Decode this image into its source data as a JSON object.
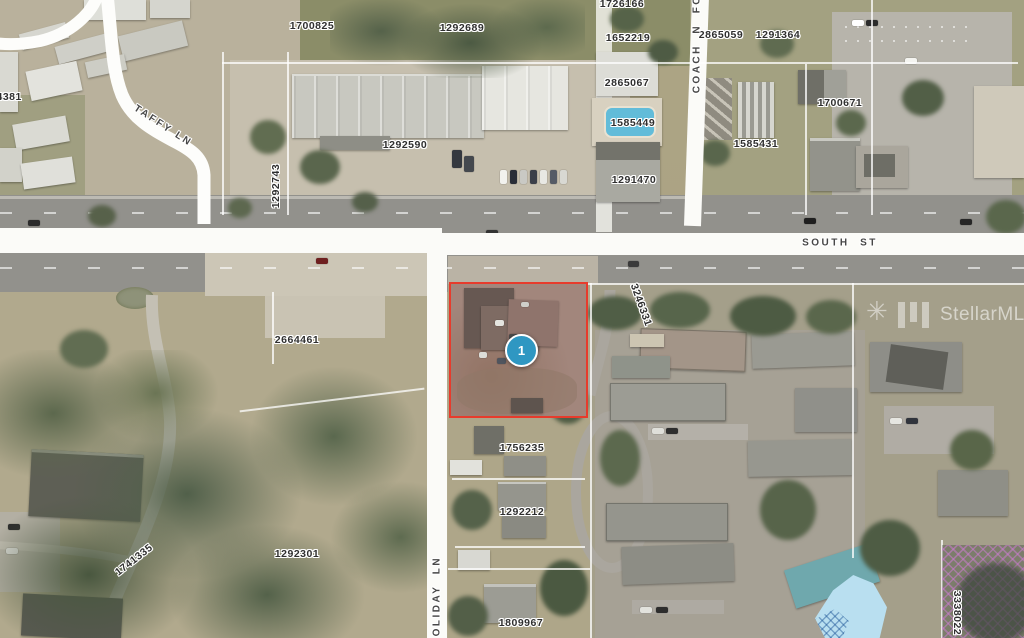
{
  "map": {
    "street_labels": [
      {
        "text": "TAFFY LN",
        "x": 163,
        "y": 126,
        "rot": 33
      },
      {
        "text": "SOUTH  ST",
        "x": 840,
        "y": 243,
        "rot": 0
      },
      {
        "text": "COACH  N  FOU",
        "x": 697,
        "y": 39,
        "rot": -90
      },
      {
        "text": "HOLIDAY  LN",
        "x": 437,
        "y": 601,
        "rot": -90
      }
    ],
    "parcel_labels": [
      {
        "text": "1700825",
        "x": 312,
        "y": 26,
        "rot": 0
      },
      {
        "text": "1292689",
        "x": 462,
        "y": 28,
        "rot": 0
      },
      {
        "text": "1726166",
        "x": 622,
        "y": 4,
        "rot": 0
      },
      {
        "text": "1652219",
        "x": 628,
        "y": 38,
        "rot": 0
      },
      {
        "text": "2865059",
        "x": 721,
        "y": 35,
        "rot": 0
      },
      {
        "text": "1291364",
        "x": 778,
        "y": 35,
        "rot": 0
      },
      {
        "text": "2865067",
        "x": 627,
        "y": 83,
        "rot": 0
      },
      {
        "text": "1585449",
        "x": 633,
        "y": 123,
        "rot": 0
      },
      {
        "text": "1700671",
        "x": 840,
        "y": 103,
        "rot": 0
      },
      {
        "text": "1585431",
        "x": 756,
        "y": 144,
        "rot": 0
      },
      {
        "text": "1292590",
        "x": 405,
        "y": 145,
        "rot": 0
      },
      {
        "text": "1291470",
        "x": 634,
        "y": 180,
        "rot": 0
      },
      {
        "text": "74381",
        "x": 6,
        "y": 97,
        "rot": 0
      },
      {
        "text": "1292743",
        "x": 276,
        "y": 186,
        "rot": -90
      },
      {
        "text": "3246331",
        "x": 641,
        "y": 305,
        "rot": 70
      },
      {
        "text": "2664461",
        "x": 297,
        "y": 340,
        "rot": 0
      },
      {
        "text": "1756235",
        "x": 522,
        "y": 448,
        "rot": 0
      },
      {
        "text": "1292212",
        "x": 522,
        "y": 512,
        "rot": 0
      },
      {
        "text": "1292301",
        "x": 297,
        "y": 554,
        "rot": 0
      },
      {
        "text": "1741335",
        "x": 134,
        "y": 560,
        "rot": -38
      },
      {
        "text": "1809967",
        "x": 521,
        "y": 623,
        "rot": 0
      },
      {
        "text": "3338022",
        "x": 957,
        "y": 613,
        "rot": 90
      }
    ],
    "marker": {
      "label": "1",
      "fill": "#2f97c2"
    },
    "selected_parcel": {
      "outline": "#e73b2c"
    },
    "watermark": {
      "text": "StellarMLS"
    }
  }
}
